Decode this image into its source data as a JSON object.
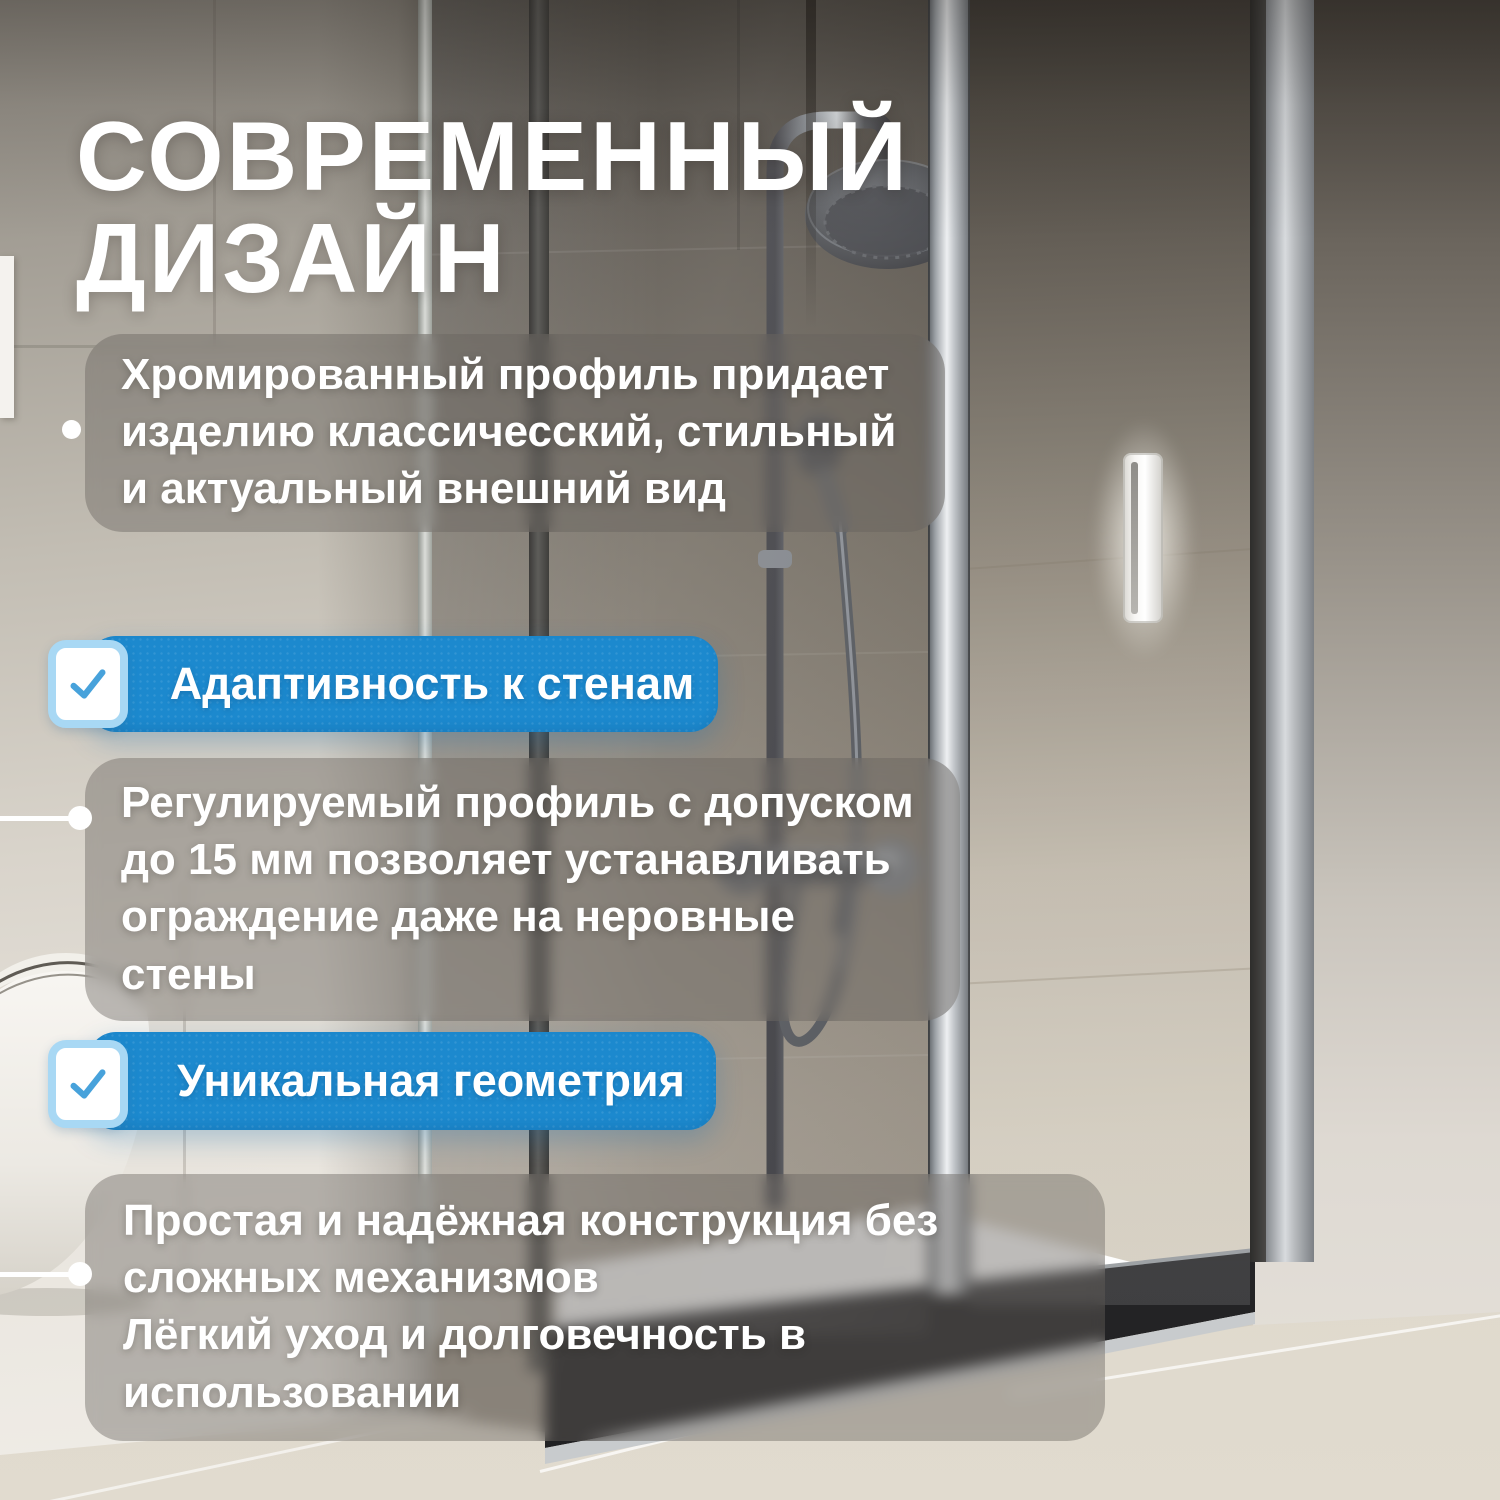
{
  "card": {
    "headline": {
      "line1": "СОВРЕМЕННЫЙ",
      "line2": "ДИЗАЙН"
    },
    "features": {
      "p1": {
        "text": "Хромированный профиль придает изделию классичесский, стильный и актуальный внешний вид"
      },
      "p2": {
        "text": "Регулируемый профиль с допуском до 15 мм позволяет устанавливать ограждение даже на неровные стены"
      },
      "p3": {
        "line1": "Простая и надёжная конструкция без сложных механизмов",
        "line2": "Лёгкий уход и долговечность в использовании"
      }
    },
    "badges": {
      "b1": {
        "label": "Адаптивность к стенам",
        "icon": "checkbox-checked-icon"
      },
      "b2": {
        "label": "Уникальная геометрия",
        "icon": "checkbox-checked-icon"
      }
    },
    "colors": {
      "badge_blue": "#1c89ce",
      "checkbox_border": "#a8d8f4",
      "checkmark_blue": "#47a2db",
      "panel_overlay": "rgba(103,98,92,0.42)",
      "text": "#ffffff"
    }
  }
}
